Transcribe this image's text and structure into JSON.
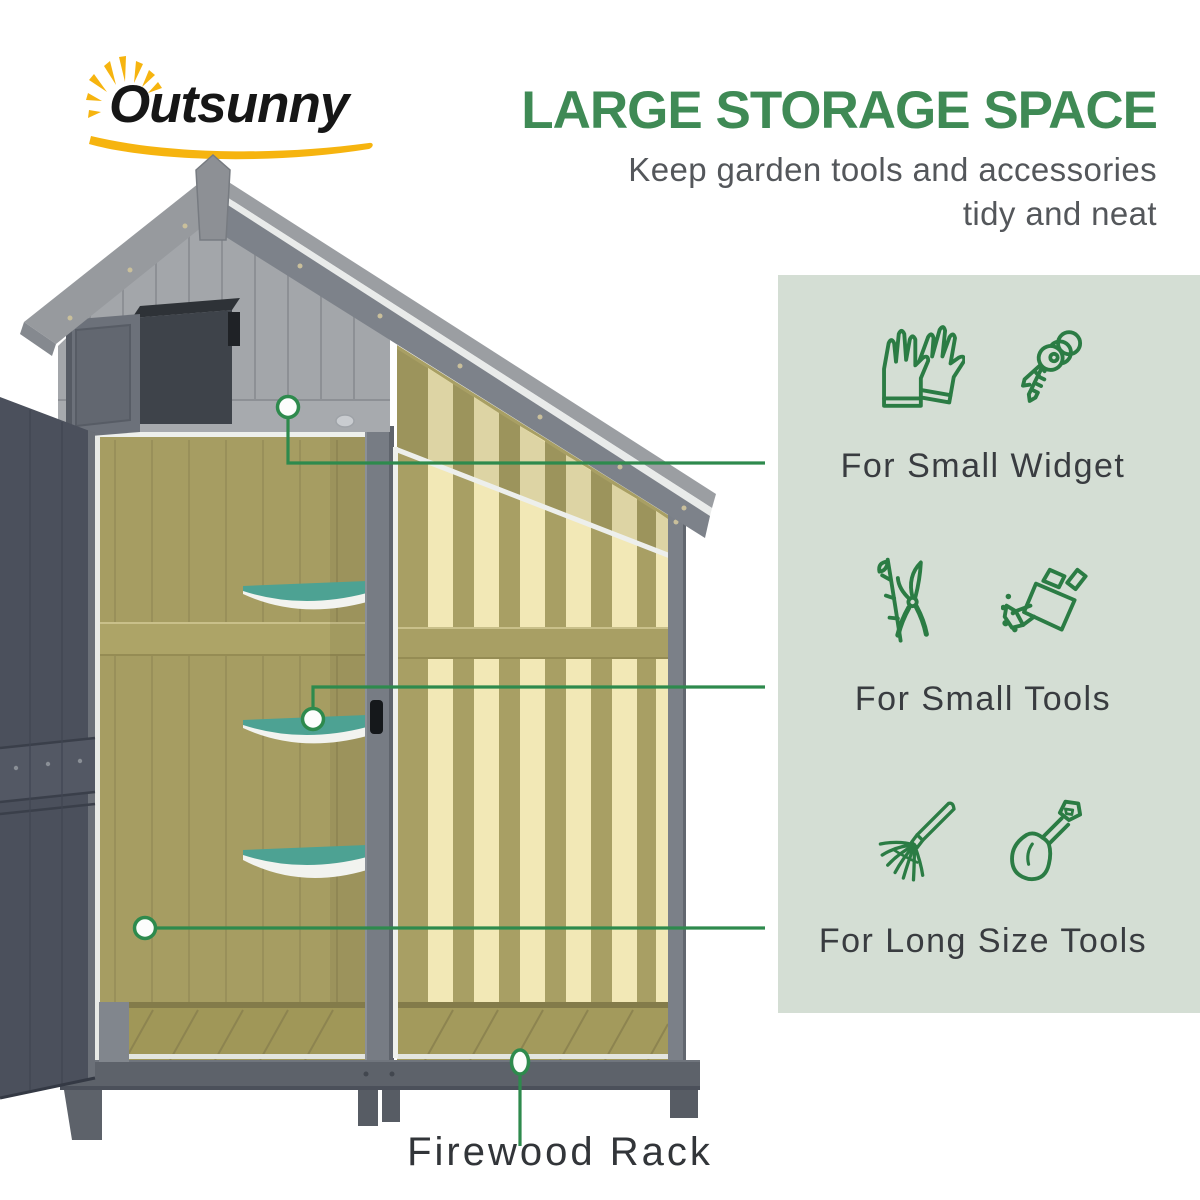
{
  "logo": {
    "brand": "Outsunny"
  },
  "header": {
    "title": "LARGE STORAGE SPACE",
    "subtitle_line1": "Keep garden tools and accessories",
    "subtitle_line2": "tidy and neat"
  },
  "panel": {
    "features": [
      {
        "label": "For Small Widget",
        "icons": [
          "gloves-icon",
          "keys-icon"
        ]
      },
      {
        "label": "For Small Tools",
        "icons": [
          "pruning-shears-icon",
          "watering-can-icon"
        ]
      },
      {
        "label": "For Long Size Tools",
        "icons": [
          "leaf-rake-icon",
          "shovel-icon"
        ]
      }
    ]
  },
  "callouts": {
    "firewood_label": "Firewood Rack"
  },
  "colors": {
    "title_green": "#3f8a55",
    "icon_green": "#2b7c44",
    "callout_green": "#2e8a4d",
    "panel_sage": "#d4ded4",
    "logo_yellow": "#f6b40f",
    "shed_gray": "#a3a6aa",
    "interior_olive": "#a69d62",
    "stripe_cream": "#f2e8b6",
    "shelf_teal": "#4da293"
  }
}
